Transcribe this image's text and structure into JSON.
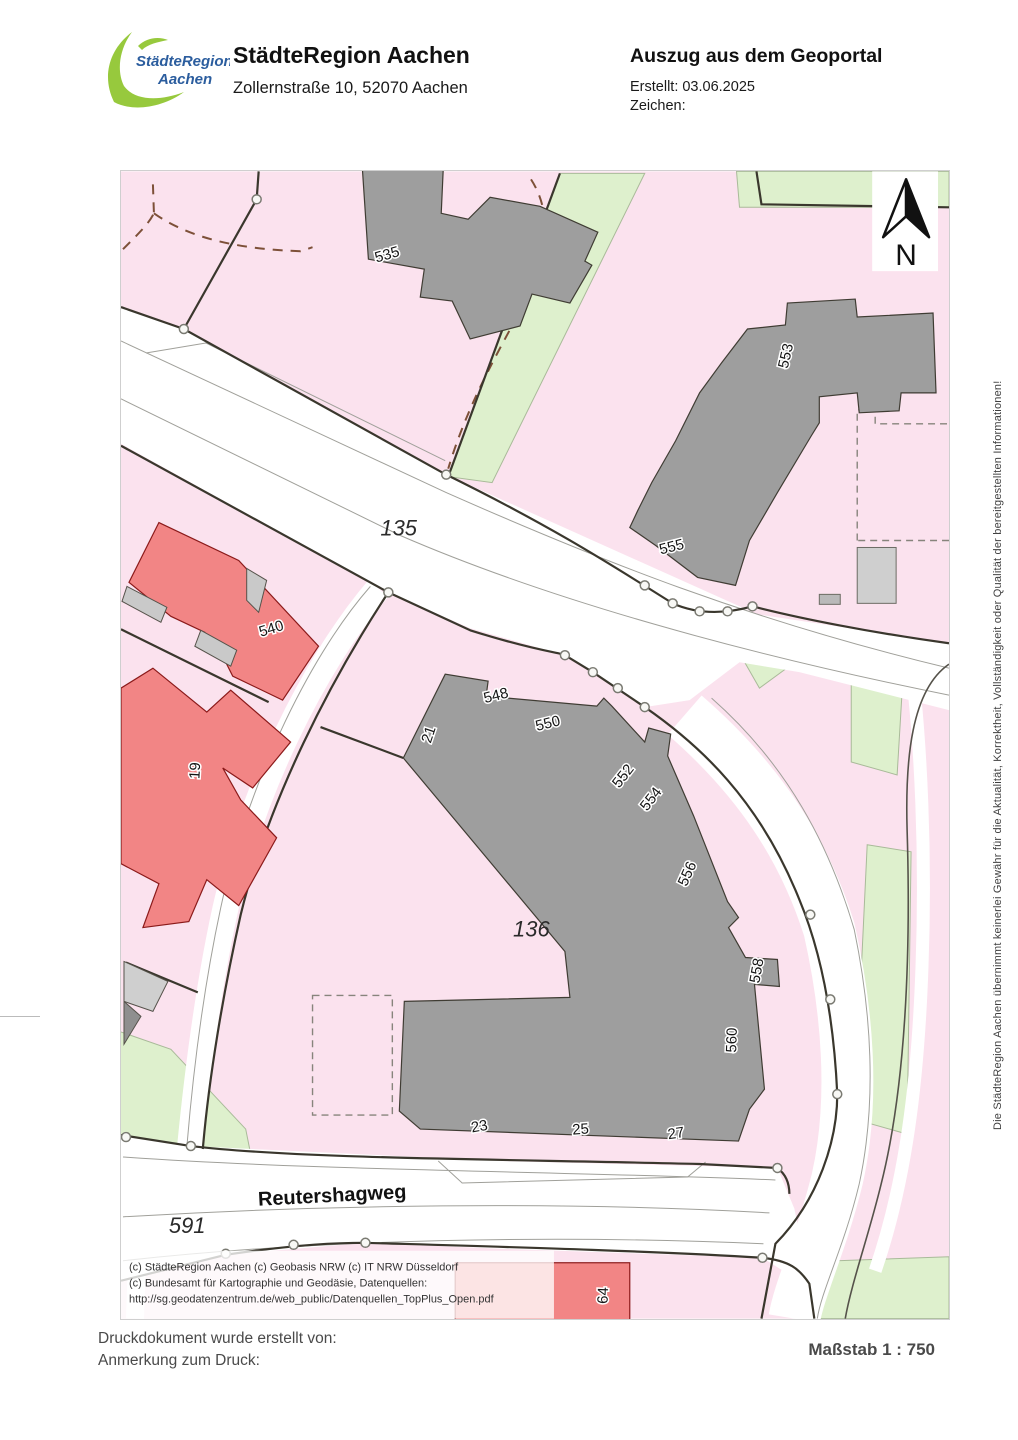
{
  "header": {
    "logo": {
      "line1": "StädteRegion",
      "line2": "Aachen"
    },
    "title": "StädteRegion Aachen",
    "subtitle": "Zollernstraße 10, 52070 Aachen",
    "doc_title": "Auszug aus dem Geoportal",
    "created_label": "Erstellt: 03.06.2025",
    "reference_label": "Zeichen:"
  },
  "map": {
    "north_indicator": "N",
    "street_label": "Reutershagweg",
    "parcel_labels": [
      {
        "text": "135"
      },
      {
        "text": "136"
      },
      {
        "text": "591"
      }
    ],
    "building_labels": [
      {
        "text": "535"
      },
      {
        "text": "553"
      },
      {
        "text": "555"
      },
      {
        "text": "540"
      },
      {
        "text": "19"
      },
      {
        "text": "21"
      },
      {
        "text": "548"
      },
      {
        "text": "550"
      },
      {
        "text": "552"
      },
      {
        "text": "554"
      },
      {
        "text": "556"
      },
      {
        "text": "558"
      },
      {
        "text": "560"
      },
      {
        "text": "23"
      },
      {
        "text": "25"
      },
      {
        "text": "27"
      },
      {
        "text": "64"
      }
    ],
    "copyright": [
      "(c) StädteRegion Aachen   (c) Geobasis NRW   (c) IT NRW Düsseldorf",
      "(c) Bundesamt für Kartographie und Geodäsie, Datenquellen:",
      "http://sg.geodatenzentrum.de/web_public/Datenquellen_TopPlus_Open.pdf"
    ]
  },
  "disclaimer": "Die StädteRegion Aachen übernimmt keinerlei Gewähr für die Aktualität, Korrektheit, Vollständigkeit oder Qualität der bereitgestellten Informationen!",
  "footer": {
    "created_by": "Druckdokument wurde erstellt von:",
    "print_note": "Anmerkung zum Druck:",
    "scale": "Maßstab 1 : 750"
  },
  "colors": {
    "parcel_pink": "#fbe2ee",
    "building_gray": "#9e9e9e",
    "building_light_gray": "#cfcfcf",
    "building_red": "#f28585",
    "greenery": "#def0cd",
    "boundary_dark": "#3a372d",
    "path_dash_brown": "#7d5038",
    "logo_green": "#97c93d",
    "logo_blue": "#2b5d9e"
  }
}
